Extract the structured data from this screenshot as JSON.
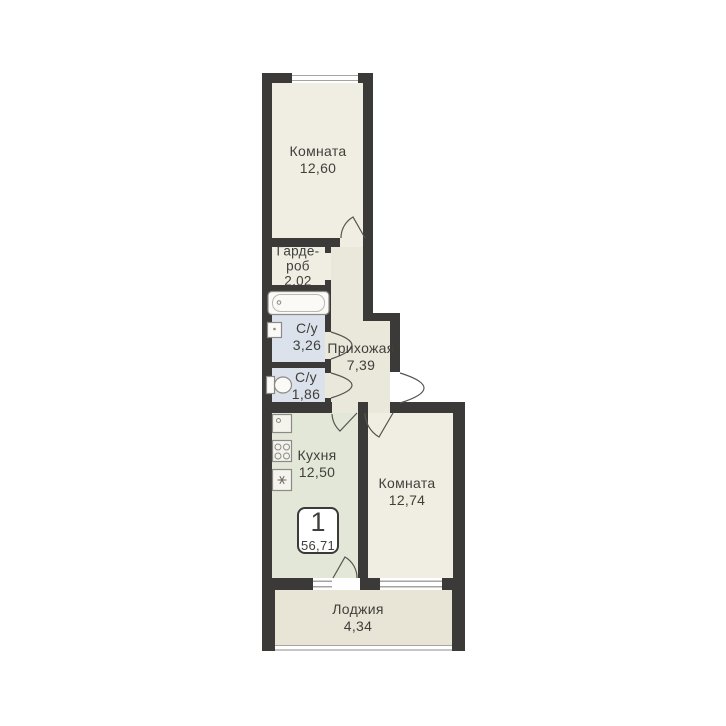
{
  "floorplan": {
    "badge": {
      "number": "1",
      "total_area": "56,71"
    },
    "rooms": {
      "room_top": {
        "name": "Комната",
        "area": "12,60"
      },
      "wardrobe": {
        "name_line1": "Гарде-",
        "name_line2": "роб",
        "area": "2,02"
      },
      "bath_large": {
        "name": "С/у",
        "area": "3,26"
      },
      "bath_small": {
        "name": "С/у",
        "area": "1,86"
      },
      "hallway": {
        "name": "Прихожая",
        "area": "7,39"
      },
      "kitchen": {
        "name": "Кухня",
        "area": "12,50"
      },
      "room_bottom": {
        "name": "Комната",
        "area": "12,74"
      },
      "loggia": {
        "name": "Лоджия",
        "area": "4,34"
      }
    },
    "colors": {
      "wall": "#3b3a38",
      "room": "#f0ede3",
      "hall": "#eae8db",
      "bath": "#dce2ec",
      "kitchen": "#e3e7d8",
      "loggia": "#e8e5d7",
      "text": "#403f3b",
      "window_line": "#a5a4a0",
      "badge_border": "#3b3a38",
      "fixture_stroke": "#8b8a86",
      "door_arc": "#55544f"
    }
  }
}
